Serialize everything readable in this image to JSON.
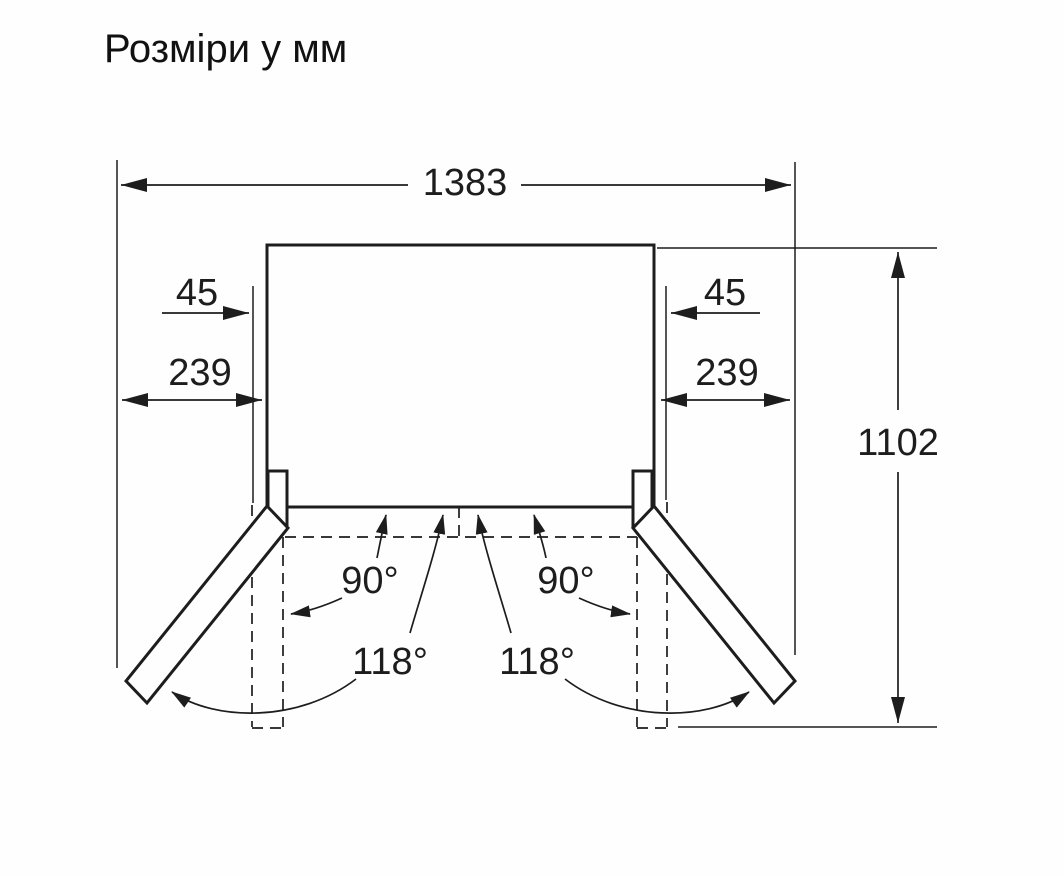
{
  "title": "Розміри у мм",
  "diagram": {
    "type": "refrigerator-top-view-installation-clearance",
    "dimensions": {
      "total_width": "1383",
      "inner_width": "905",
      "left_clearance": "239",
      "right_clearance": "239",
      "left_door_offset": "45",
      "right_door_offset": "45",
      "depth_with_open_doors": "1102"
    },
    "angles": {
      "left_90": "90°",
      "right_90": "90°",
      "left_118": "118°",
      "right_118": "118°"
    },
    "colors": {
      "line": "#1d1d1d",
      "background": "#fefefe"
    }
  }
}
